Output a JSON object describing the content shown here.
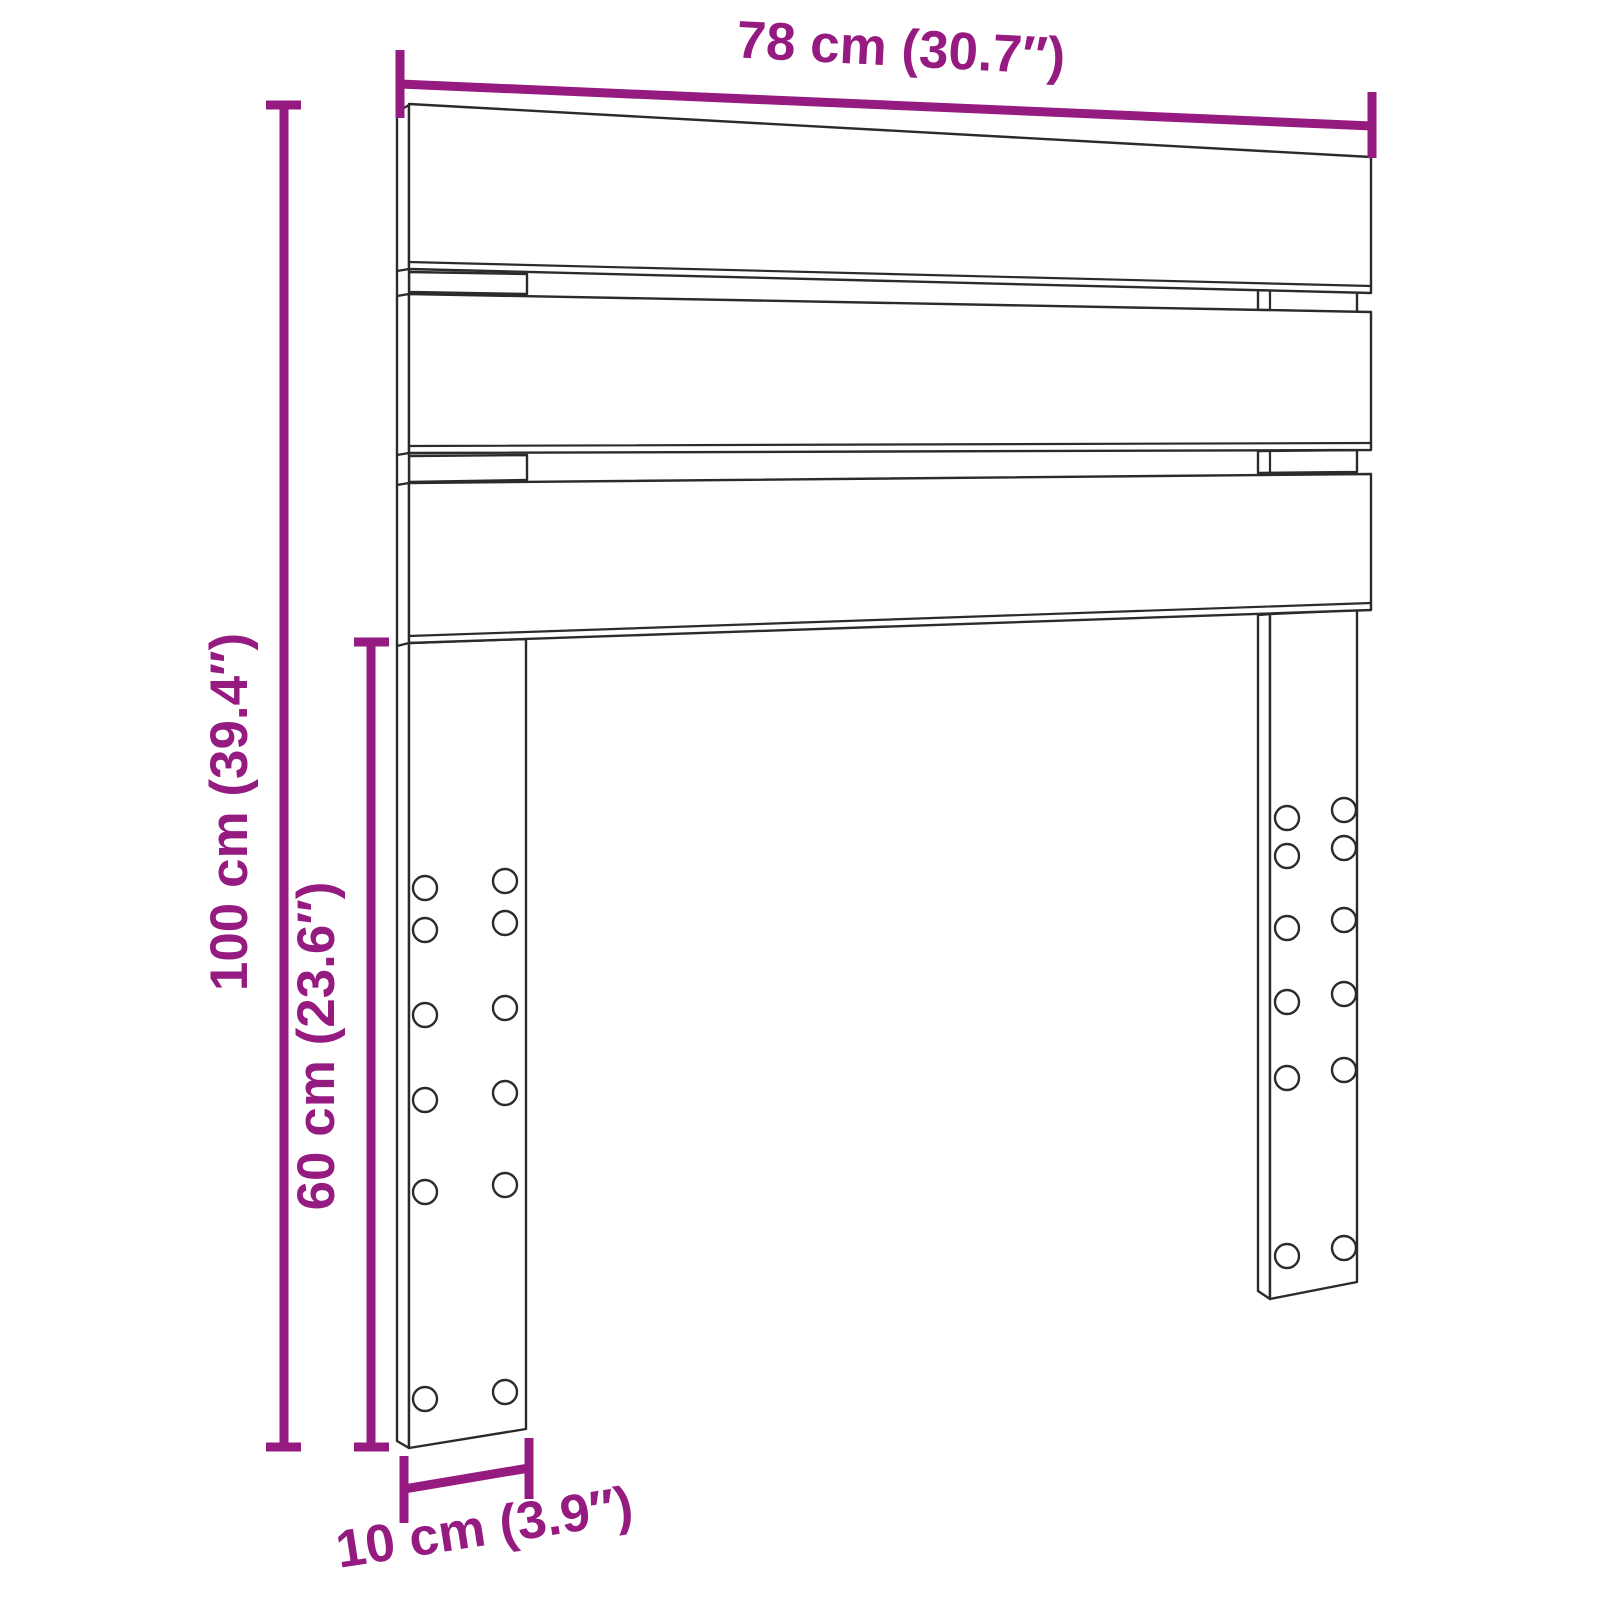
{
  "diagram": {
    "type": "product-dimension-diagram",
    "product": "Headboard with three slats and two mounting legs",
    "background_color": "#FFFFFF",
    "outline_color": "#2B2B2B",
    "dimension_color": "#951B81",
    "dimensions": {
      "width": {
        "label": "78 cm (30.7″)",
        "cm": 78,
        "inches": 30.7
      },
      "height": {
        "label": "100 cm (39.4″)",
        "cm": 100,
        "inches": 39.4
      },
      "leg_height": {
        "label": "60 cm (23.6″)",
        "cm": 60,
        "inches": 23.6
      },
      "leg_width": {
        "label": "10 cm (3.9″)",
        "cm": 10,
        "inches": 3.9
      }
    },
    "features": {
      "slat_count": 3,
      "leg_count": 2,
      "holes_per_leg": 12
    }
  }
}
